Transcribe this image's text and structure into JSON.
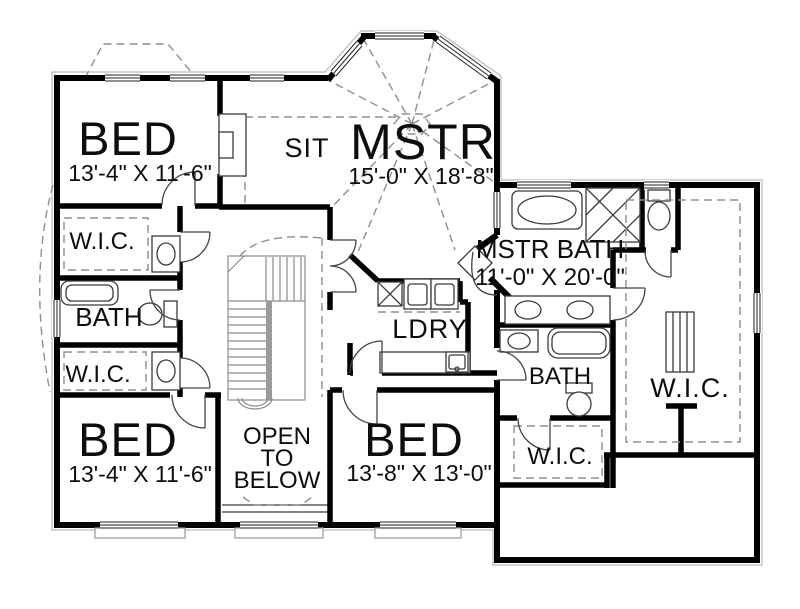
{
  "plan": {
    "rooms": {
      "bed_top_left": {
        "label": "BED",
        "dims": "13'-4\" X 11'-6\""
      },
      "sit": {
        "label": "SIT"
      },
      "master": {
        "label": "MSTR",
        "dims": "15'-0\" X 18'-8\""
      },
      "wic_upper_left": {
        "label": "W.I.C."
      },
      "bath_left": {
        "label": "BATH"
      },
      "wic_lower_left": {
        "label": "W.I.C."
      },
      "master_bath": {
        "label": "MSTR BATH",
        "dims": "11'-0\" X 20'-0\""
      },
      "laundry": {
        "label": "LDRY"
      },
      "bath_right": {
        "label": "BATH"
      },
      "wic_bottom_right": {
        "label": "W.I.C."
      },
      "wic_right": {
        "label": "W.I.C."
      },
      "bed_bottom_left": {
        "label": "BED",
        "dims": "13'-4\" X 11'-6\""
      },
      "bed_bottom_middle": {
        "label": "BED",
        "dims": "13'-8\" X 13'-0\""
      },
      "open_to_below": {
        "line1": "OPEN",
        "line2": "TO",
        "line3": "BELOW"
      }
    },
    "colors": {
      "wall": "#000000",
      "background": "#ffffff",
      "detail": "#3a3a3a",
      "dashed": "#8f8f8f",
      "light_outline": "#c4c4c4"
    }
  }
}
